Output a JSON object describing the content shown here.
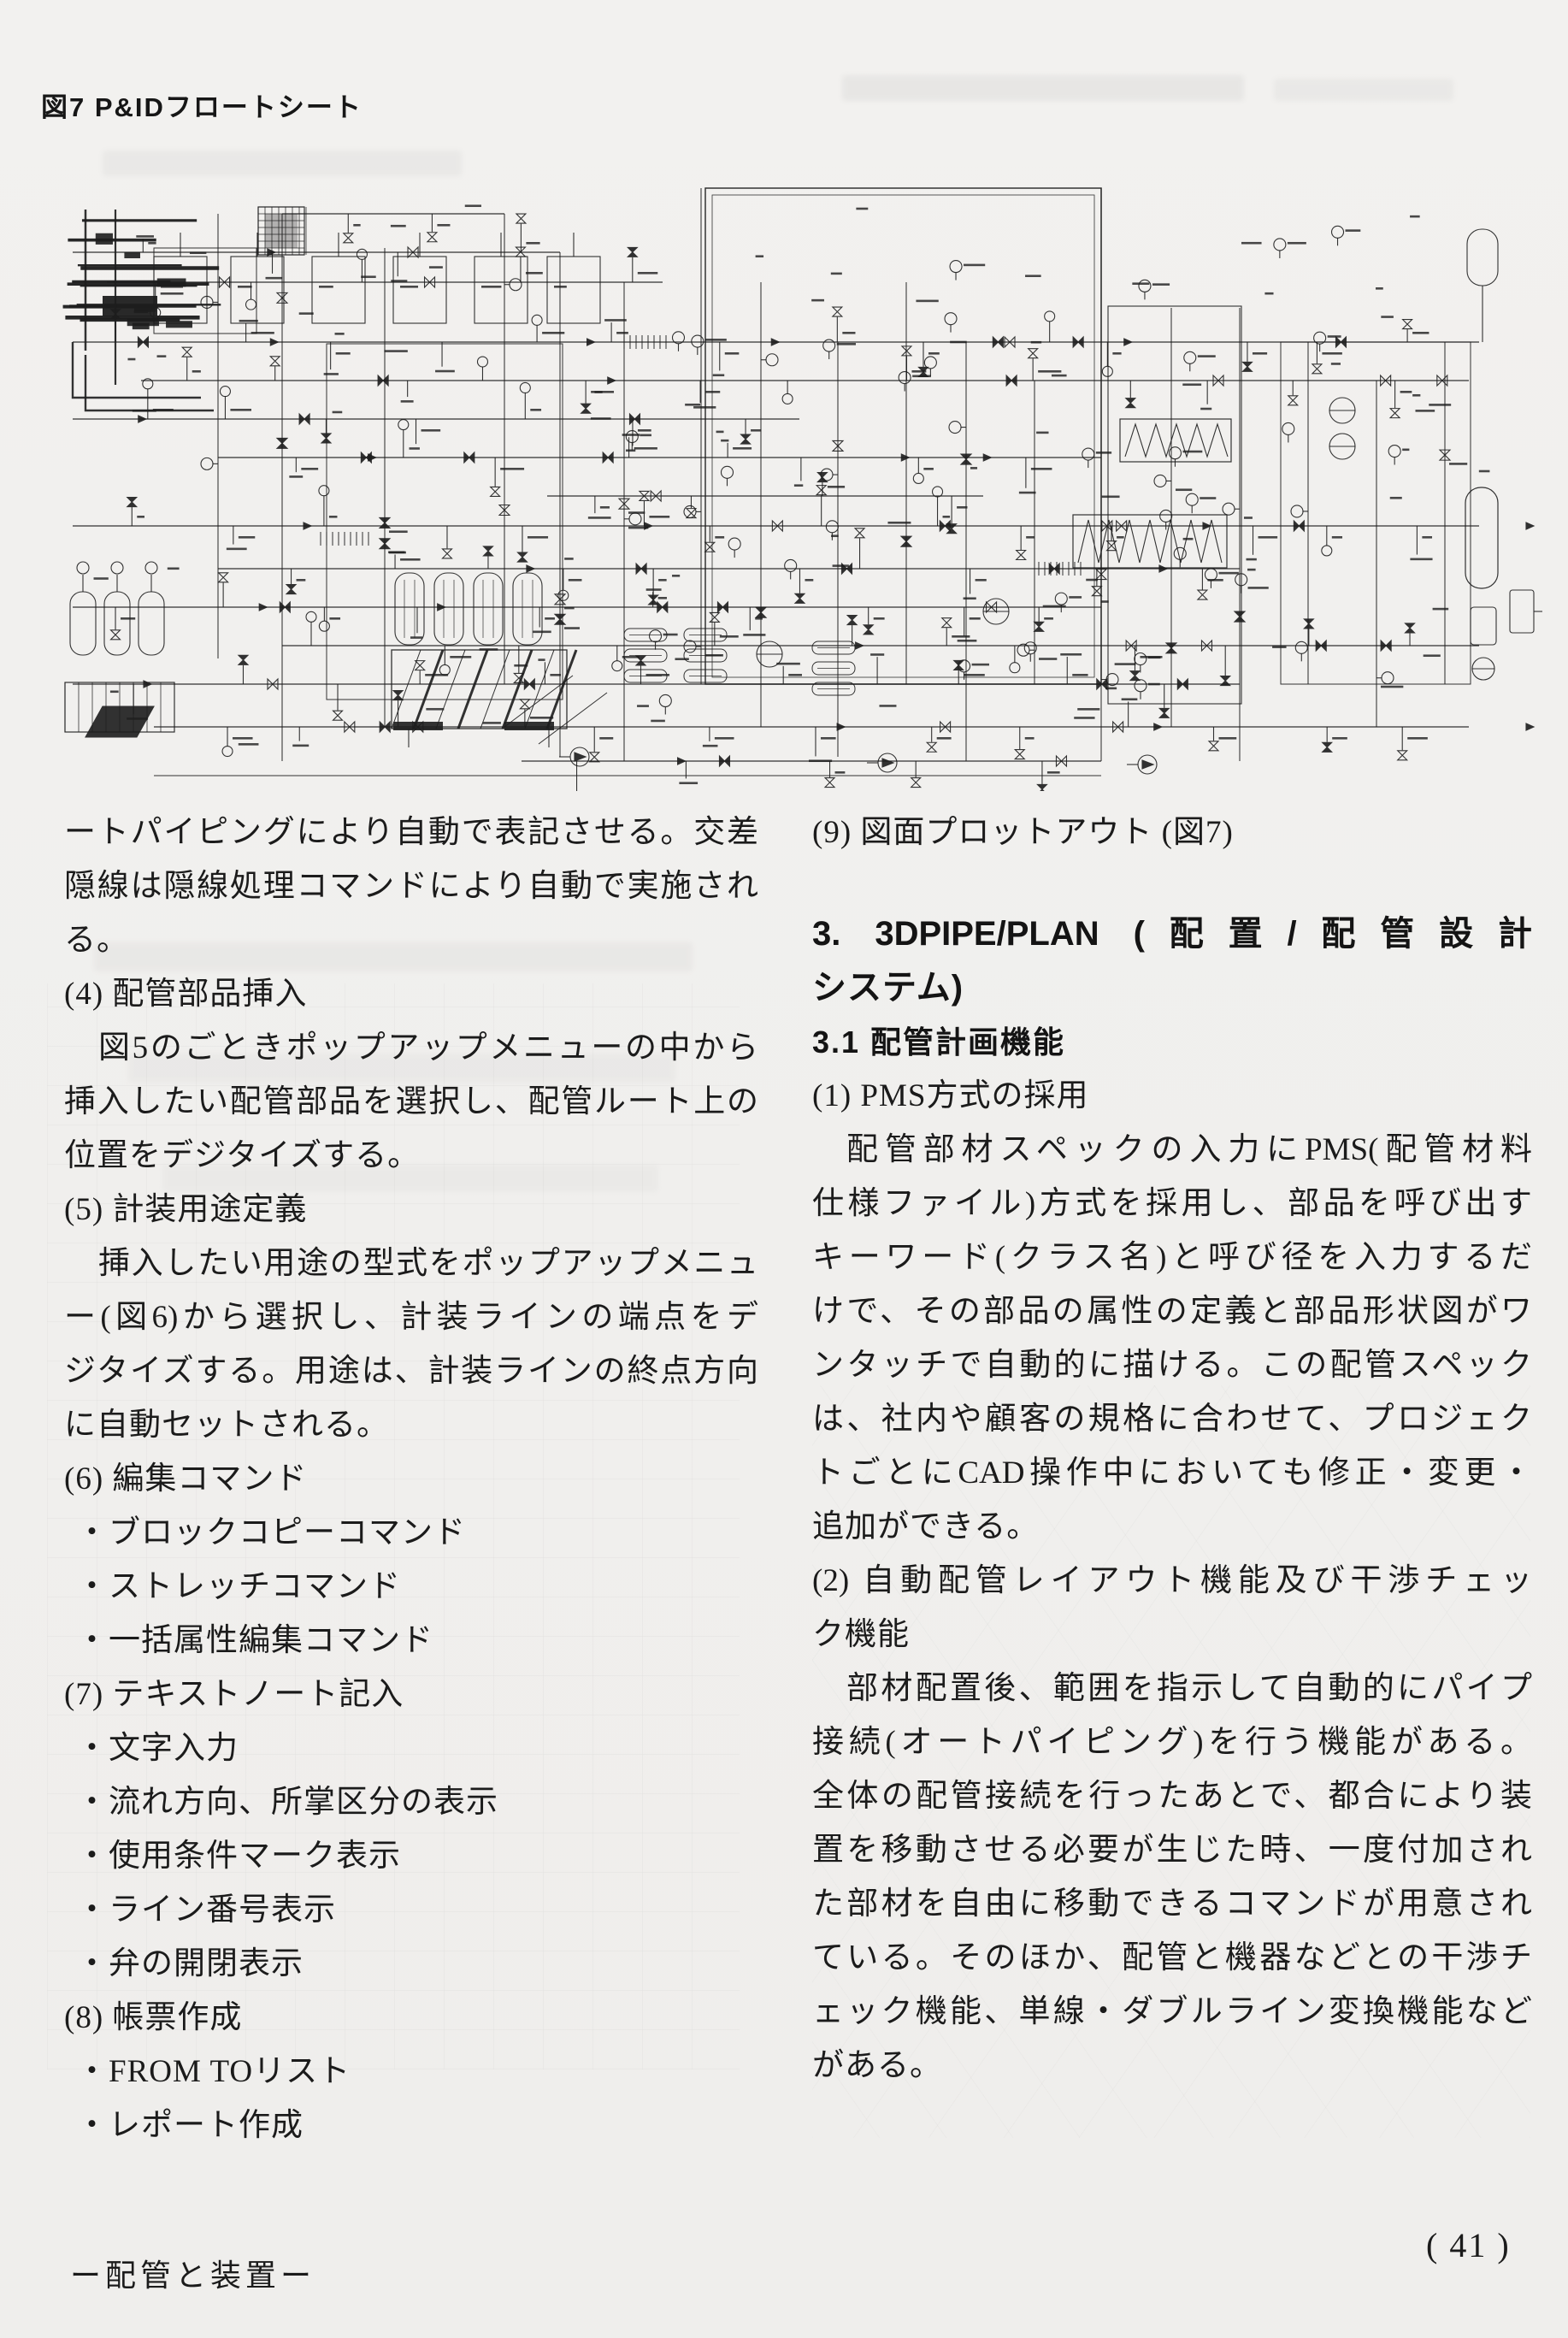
{
  "page": {
    "background": "#f1f0ee",
    "ink": "#1c1c1c",
    "figure_caption": "図7 P&IDフロートシート",
    "diagram_description": "P&ID flow sheet (scanned engineering drawing, illegible fine labels)",
    "footer_left": "ー配管と装置ー",
    "page_number": "( 41 )"
  },
  "left_column": {
    "lines": [
      {
        "text": "ートパイピングにより自動で表記させる。交差",
        "fill": true
      },
      {
        "text": "隠線は隠線処理コマンドにより自動で実施され",
        "fill": true
      },
      {
        "text": "る。"
      },
      {
        "text": "(4) 配管部品挿入"
      },
      {
        "text": "図5のごときポップアップメニューの中から",
        "indent": 40,
        "fill": true
      },
      {
        "text": "挿入したい配管部品を選択し、配管ルート上の",
        "fill": true
      },
      {
        "text": "位置をデジタイズする。"
      },
      {
        "text": "(5) 計装用途定義"
      },
      {
        "text": "挿入したい用途の型式をポップアップメニュ",
        "indent": 40,
        "fill": true
      },
      {
        "text": "ー(図6)から選択し、計装ラインの端点をデ",
        "fill": true
      },
      {
        "text": "ジタイズする。用途は、計装ラインの終点方向",
        "fill": true
      },
      {
        "text": "に自動セットされる。"
      },
      {
        "text": "(6) 編集コマンド"
      },
      {
        "text": "・ブロックコピーコマンド",
        "indent": 14
      },
      {
        "text": "・ストレッチコマンド",
        "indent": 14
      },
      {
        "text": "・一括属性編集コマンド",
        "indent": 14
      },
      {
        "text": "(7) テキストノート記入"
      },
      {
        "text": "・文字入力",
        "indent": 14
      },
      {
        "text": "・流れ方向、所掌区分の表示",
        "indent": 14
      },
      {
        "text": "・使用条件マーク表示",
        "indent": 14
      },
      {
        "text": "・ライン番号表示",
        "indent": 14
      },
      {
        "text": "・弁の開閉表示",
        "indent": 14
      },
      {
        "text": "(8) 帳票作成"
      },
      {
        "text": "・FROM TOリスト",
        "indent": 14
      },
      {
        "text": "・レポート作成",
        "indent": 14
      }
    ]
  },
  "right_column": {
    "lines": [
      {
        "text": "(9) 図面プロットアウト (図7)"
      },
      {
        "text": "3. 3DPIPE/PLAN (配置/配管設計",
        "style": "h1",
        "gap": 56,
        "fill": true
      },
      {
        "text": "システム)",
        "style": "h1"
      },
      {
        "text": "3.1 配管計画機能",
        "style": "h2"
      },
      {
        "text": "(1) PMS方式の採用"
      },
      {
        "text": "配管部材スペックの入力にPMS(配管材料",
        "indent": 40,
        "fill": true
      },
      {
        "text": "仕様ファイル)方式を採用し、部品を呼び出す",
        "fill": true
      },
      {
        "text": "キーワード(クラス名)と呼び径を入力するだ",
        "fill": true
      },
      {
        "text": "けで、その部品の属性の定義と部品形状図がワ",
        "fill": true
      },
      {
        "text": "ンタッチで自動的に描ける。この配管スペック",
        "fill": true
      },
      {
        "text": "は、社内や顧客の規格に合わせて、プロジェク",
        "fill": true
      },
      {
        "text": "トごとにCAD操作中においても修正・変更・",
        "fill": true
      },
      {
        "text": "追加ができる。"
      },
      {
        "text": "(2) 自動配管レイアウト機能及び干渉チェッ",
        "fill": true
      },
      {
        "text": "ク機能"
      },
      {
        "text": "部材配置後、範囲を指示して自動的にパイプ",
        "indent": 40,
        "fill": true
      },
      {
        "text": "接続(オートパイピング)を行う機能がある。",
        "fill": true
      },
      {
        "text": "全体の配管接続を行ったあとで、都合により装",
        "fill": true
      },
      {
        "text": "置を移動させる必要が生じた時、一度付加され",
        "fill": true
      },
      {
        "text": "た部材を自由に移動できるコマンドが用意され",
        "fill": true
      },
      {
        "text": "ている。そのほか、配管と機器などとの干渉チ",
        "fill": true
      },
      {
        "text": "ェック機能、単線・ダブルライン変換機能など",
        "fill": true
      },
      {
        "text": "がある。"
      }
    ]
  }
}
